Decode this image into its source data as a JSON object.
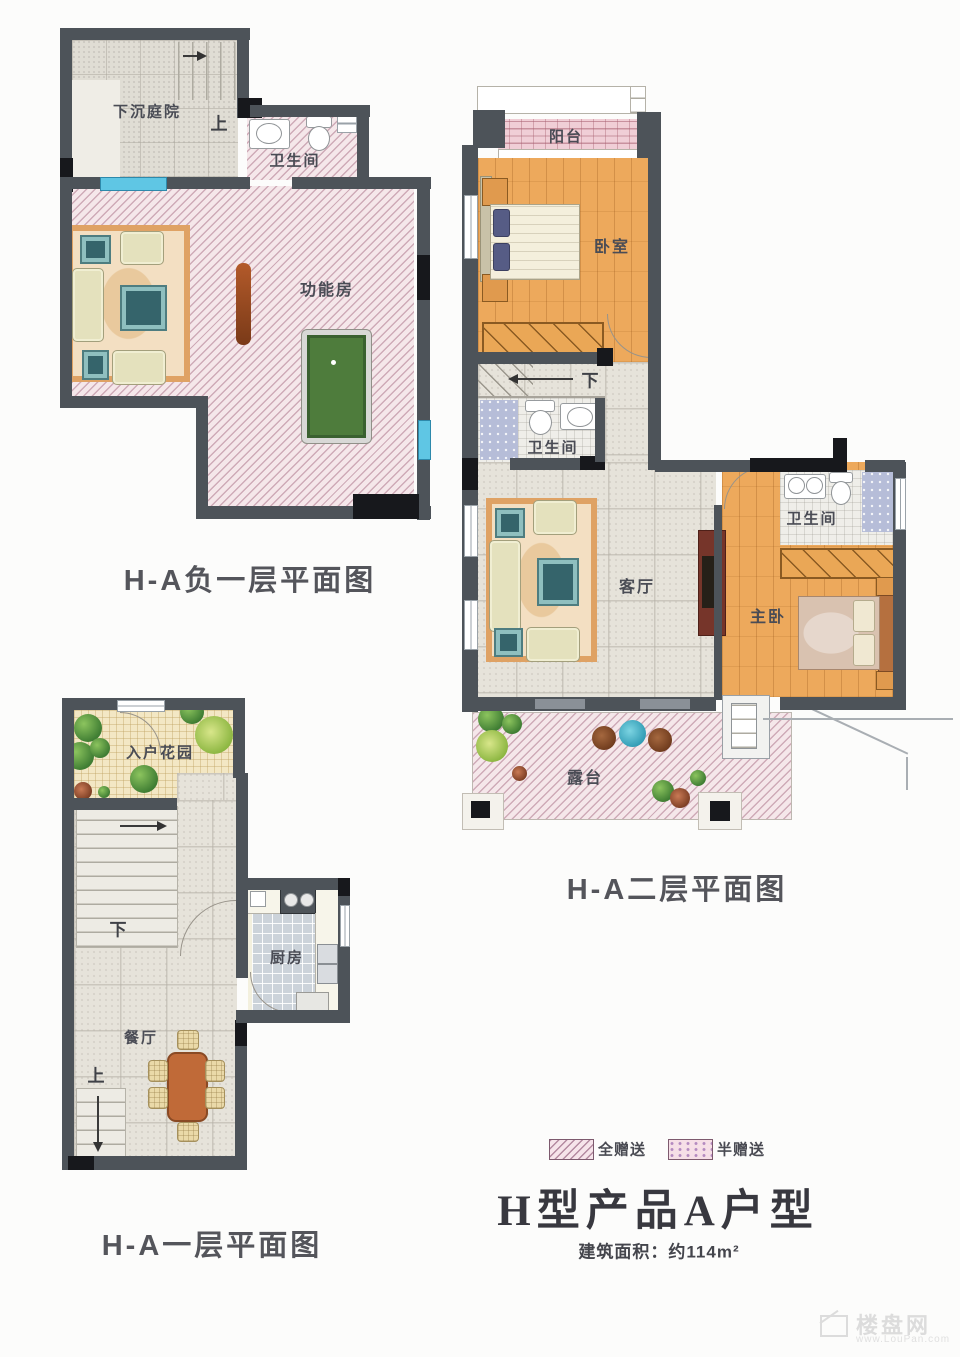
{
  "plans": {
    "basement": {
      "caption": "H-A负一层平面图",
      "rooms": {
        "courtyard": "下沉庭院",
        "bathroom": "卫生间",
        "function_room": "功能房"
      },
      "stair_up": "上"
    },
    "floor2": {
      "caption": "H-A二层平面图",
      "rooms": {
        "balcony": "阳台",
        "bedroom": "卧室",
        "hall_bathroom": "卫生间",
        "living_room": "客厅",
        "master_bedroom": "主卧",
        "master_bathroom": "卫生间",
        "terrace": "露台"
      },
      "stair_down": "下"
    },
    "floor1": {
      "caption": "H-A一层平面图",
      "rooms": {
        "entry_garden": "入户花园",
        "kitchen": "厨房",
        "dining_room": "餐厅"
      },
      "stair_down": "下",
      "stair_up": "上"
    }
  },
  "legend": {
    "full_gift": "全赠送",
    "half_gift": "半赠送"
  },
  "title_block": {
    "title": "H型产品A户型",
    "area": "建筑面积：约114m²"
  },
  "watermark": {
    "site": "楼盘网",
    "url": "www.LouPan.com"
  },
  "colors": {
    "wall": "#4d5359",
    "gift_full_hatch": "#ba8a9c",
    "gift_half_brick": "#a85f70",
    "wood_floor": "#eda95c",
    "pool_table_green": "#4e7c3c",
    "window_blue": "#5fc6e4"
  }
}
